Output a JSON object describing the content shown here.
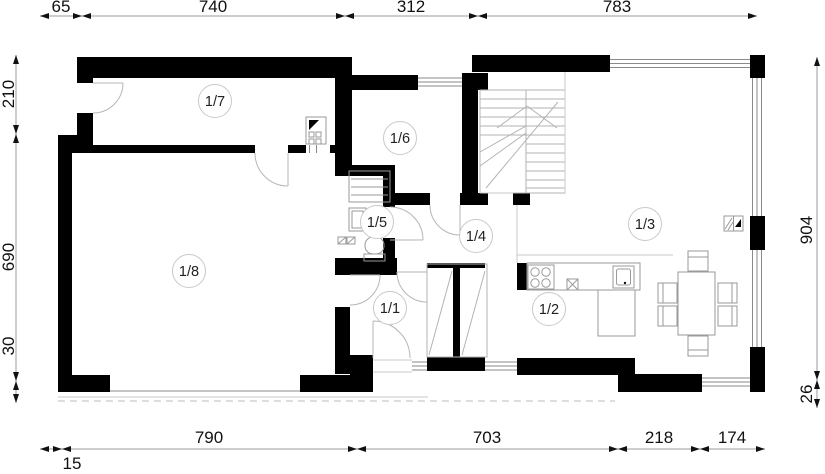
{
  "plan_title": "floor-plan",
  "rooms": [
    {
      "id": "1-7",
      "label": "1/7"
    },
    {
      "id": "1-6",
      "label": "1/6"
    },
    {
      "id": "1-5",
      "label": "1/5"
    },
    {
      "id": "1-4",
      "label": "1/4"
    },
    {
      "id": "1-3",
      "label": "1/3"
    },
    {
      "id": "1-8",
      "label": "1/8"
    },
    {
      "id": "1-1",
      "label": "1/1"
    },
    {
      "id": "1-2",
      "label": "1/2"
    }
  ],
  "dimensions": {
    "top": [
      "65",
      "740",
      "312",
      "783"
    ],
    "bottom": [
      "790",
      "703",
      "218",
      "174"
    ],
    "bottom_secondary": "15",
    "left": [
      "210",
      "690",
      "30"
    ],
    "right": [
      "904",
      "26"
    ]
  },
  "colors": {
    "wall": "#000000",
    "drawing_line": "#b3b3b3",
    "dimension_text": "#111111"
  }
}
